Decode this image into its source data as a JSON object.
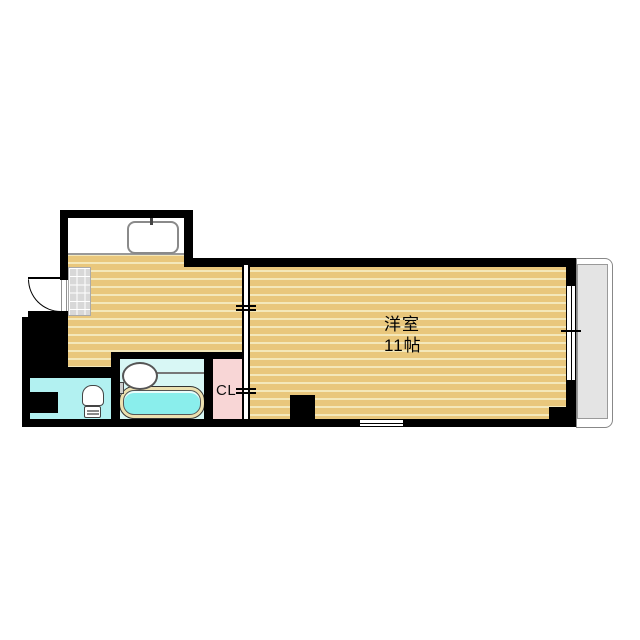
{
  "rooms": {
    "western_room": {
      "label": "洋室",
      "size": "11帖"
    },
    "closet": {
      "label": "CL"
    }
  },
  "colors": {
    "wall": "#000000",
    "floor-base": "#e9c77c",
    "floor-stripe": "#f4e8ba",
    "toilet-floor": "#b2f1f1",
    "bath-floor": "#d8f7f5",
    "tub-water": "#8aeeec",
    "tub-rim": "#ece0b0",
    "closet-floor": "#f8d6d6",
    "balcony-slab": "#e4e4e4",
    "genkan-tile": "#d8d8d8"
  },
  "fixtures": [
    "entry-door",
    "genkan-tile",
    "kitchen-sink",
    "wash-basin",
    "bathtub",
    "toilet",
    "sliding-partition",
    "window",
    "balcony"
  ]
}
